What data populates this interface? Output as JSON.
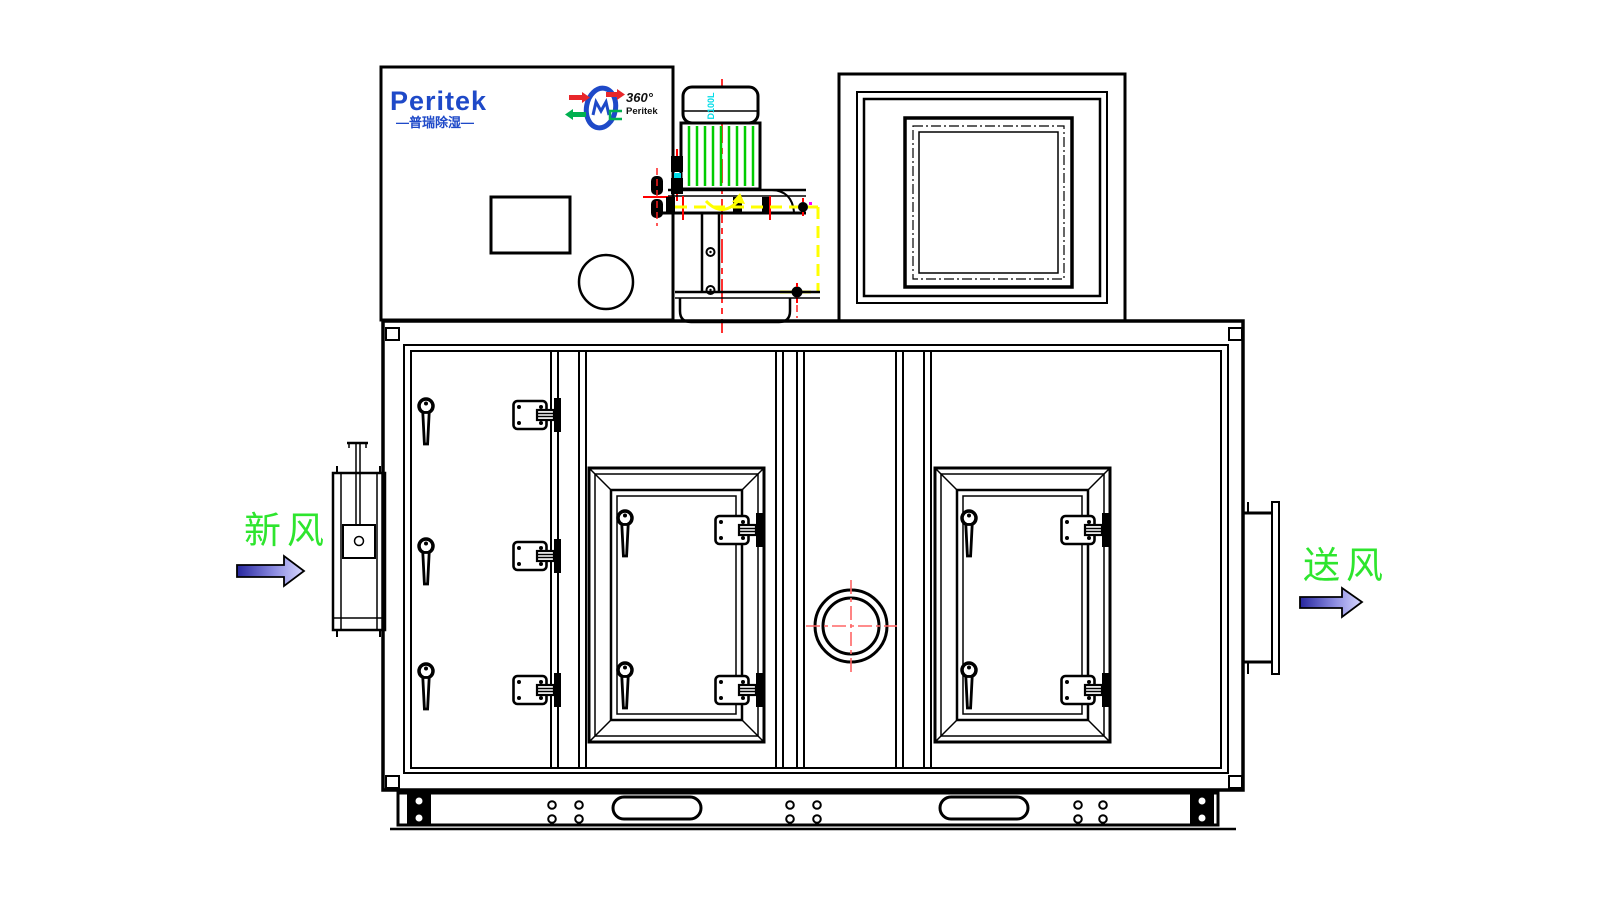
{
  "brand": {
    "logo_text": "Peritek",
    "logo_subtitle": "—普瑞除湿—"
  },
  "rotor_logo": {
    "rotation_text": "360°",
    "brand_text": "Peritek"
  },
  "motor": {
    "frame_label": "D100L"
  },
  "flow_labels": {
    "inlet": "新风",
    "outlet": "送风"
  },
  "icons": {
    "inlet_arrow": "right-arrow",
    "outlet_arrow": "right-arrow",
    "rotor_icon": "desiccant-wheel",
    "grille": "diamond-mesh-grille",
    "sight_glass": "double-circle-porthole",
    "door_handle": "teardrop-handle",
    "door_latch": "hinge-latch"
  },
  "colors": {
    "line_black": "#000000",
    "brand_blue": "#1e49c8",
    "label_green": "#2ee52e",
    "fin_green": "#00cc00",
    "centerline_red": "#ff1a1a",
    "crosshair_red": "#ff6666",
    "highlight_yellow": "#ffff00",
    "accent_cyan": "#00dce8",
    "accent_magenta": "#ff00ff",
    "arrow_gradient_dark": "#26269e",
    "arrow_gradient_light": "#d8d8ff"
  }
}
